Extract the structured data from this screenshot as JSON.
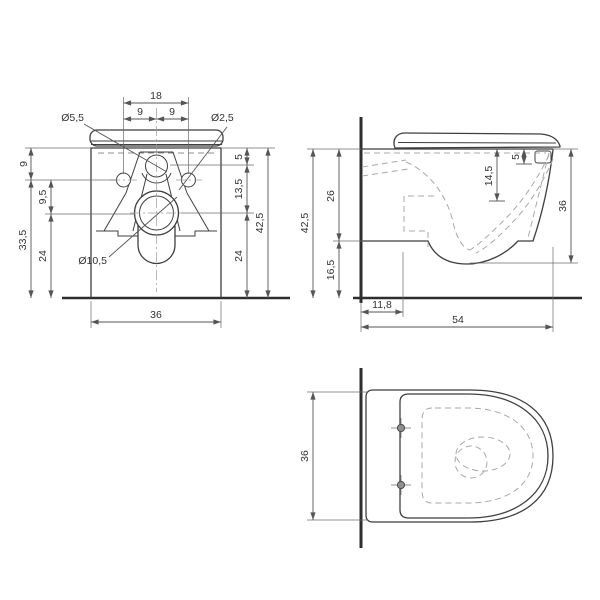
{
  "drawing_title": "wall-hung-toilet-dimension-drawing",
  "colors": {
    "line": "#3f3f3f",
    "dashed_hidden": "#a8a8a8",
    "dimension": "#555555",
    "text": "#333333",
    "background": "#ffffff"
  },
  "views": {
    "front": {
      "labels": {
        "hole_spacing_total": "18",
        "hole_spacing_left": "9",
        "hole_spacing_right": "9",
        "inlet_hole_diameter": "Ø5,5",
        "side_hole_diameter": "Ø2,5",
        "top_to_side_holes": "9",
        "side_holes_to_drain": "9,5",
        "side_holes_to_bottom": "33,5",
        "drain_to_bottom_left": "24",
        "top_to_inlet": "5",
        "inlet_to_drain": "13,5",
        "total_height": "42,5",
        "drain_to_bottom_right": "24",
        "drain_diameter": "Ø10,5",
        "total_width": "36"
      }
    },
    "side": {
      "labels": {
        "total_height": "42,5",
        "rim_to_body_underside": "26",
        "underside_to_floor": "16,5",
        "rim_to_inlet_depth": "14,5",
        "hinge_hole_depth": "5",
        "rim_to_bowl_bottom": "36",
        "wall_to_step": "11,8",
        "total_depth": "54"
      }
    },
    "top": {
      "labels": {
        "total_width": "36"
      }
    }
  }
}
